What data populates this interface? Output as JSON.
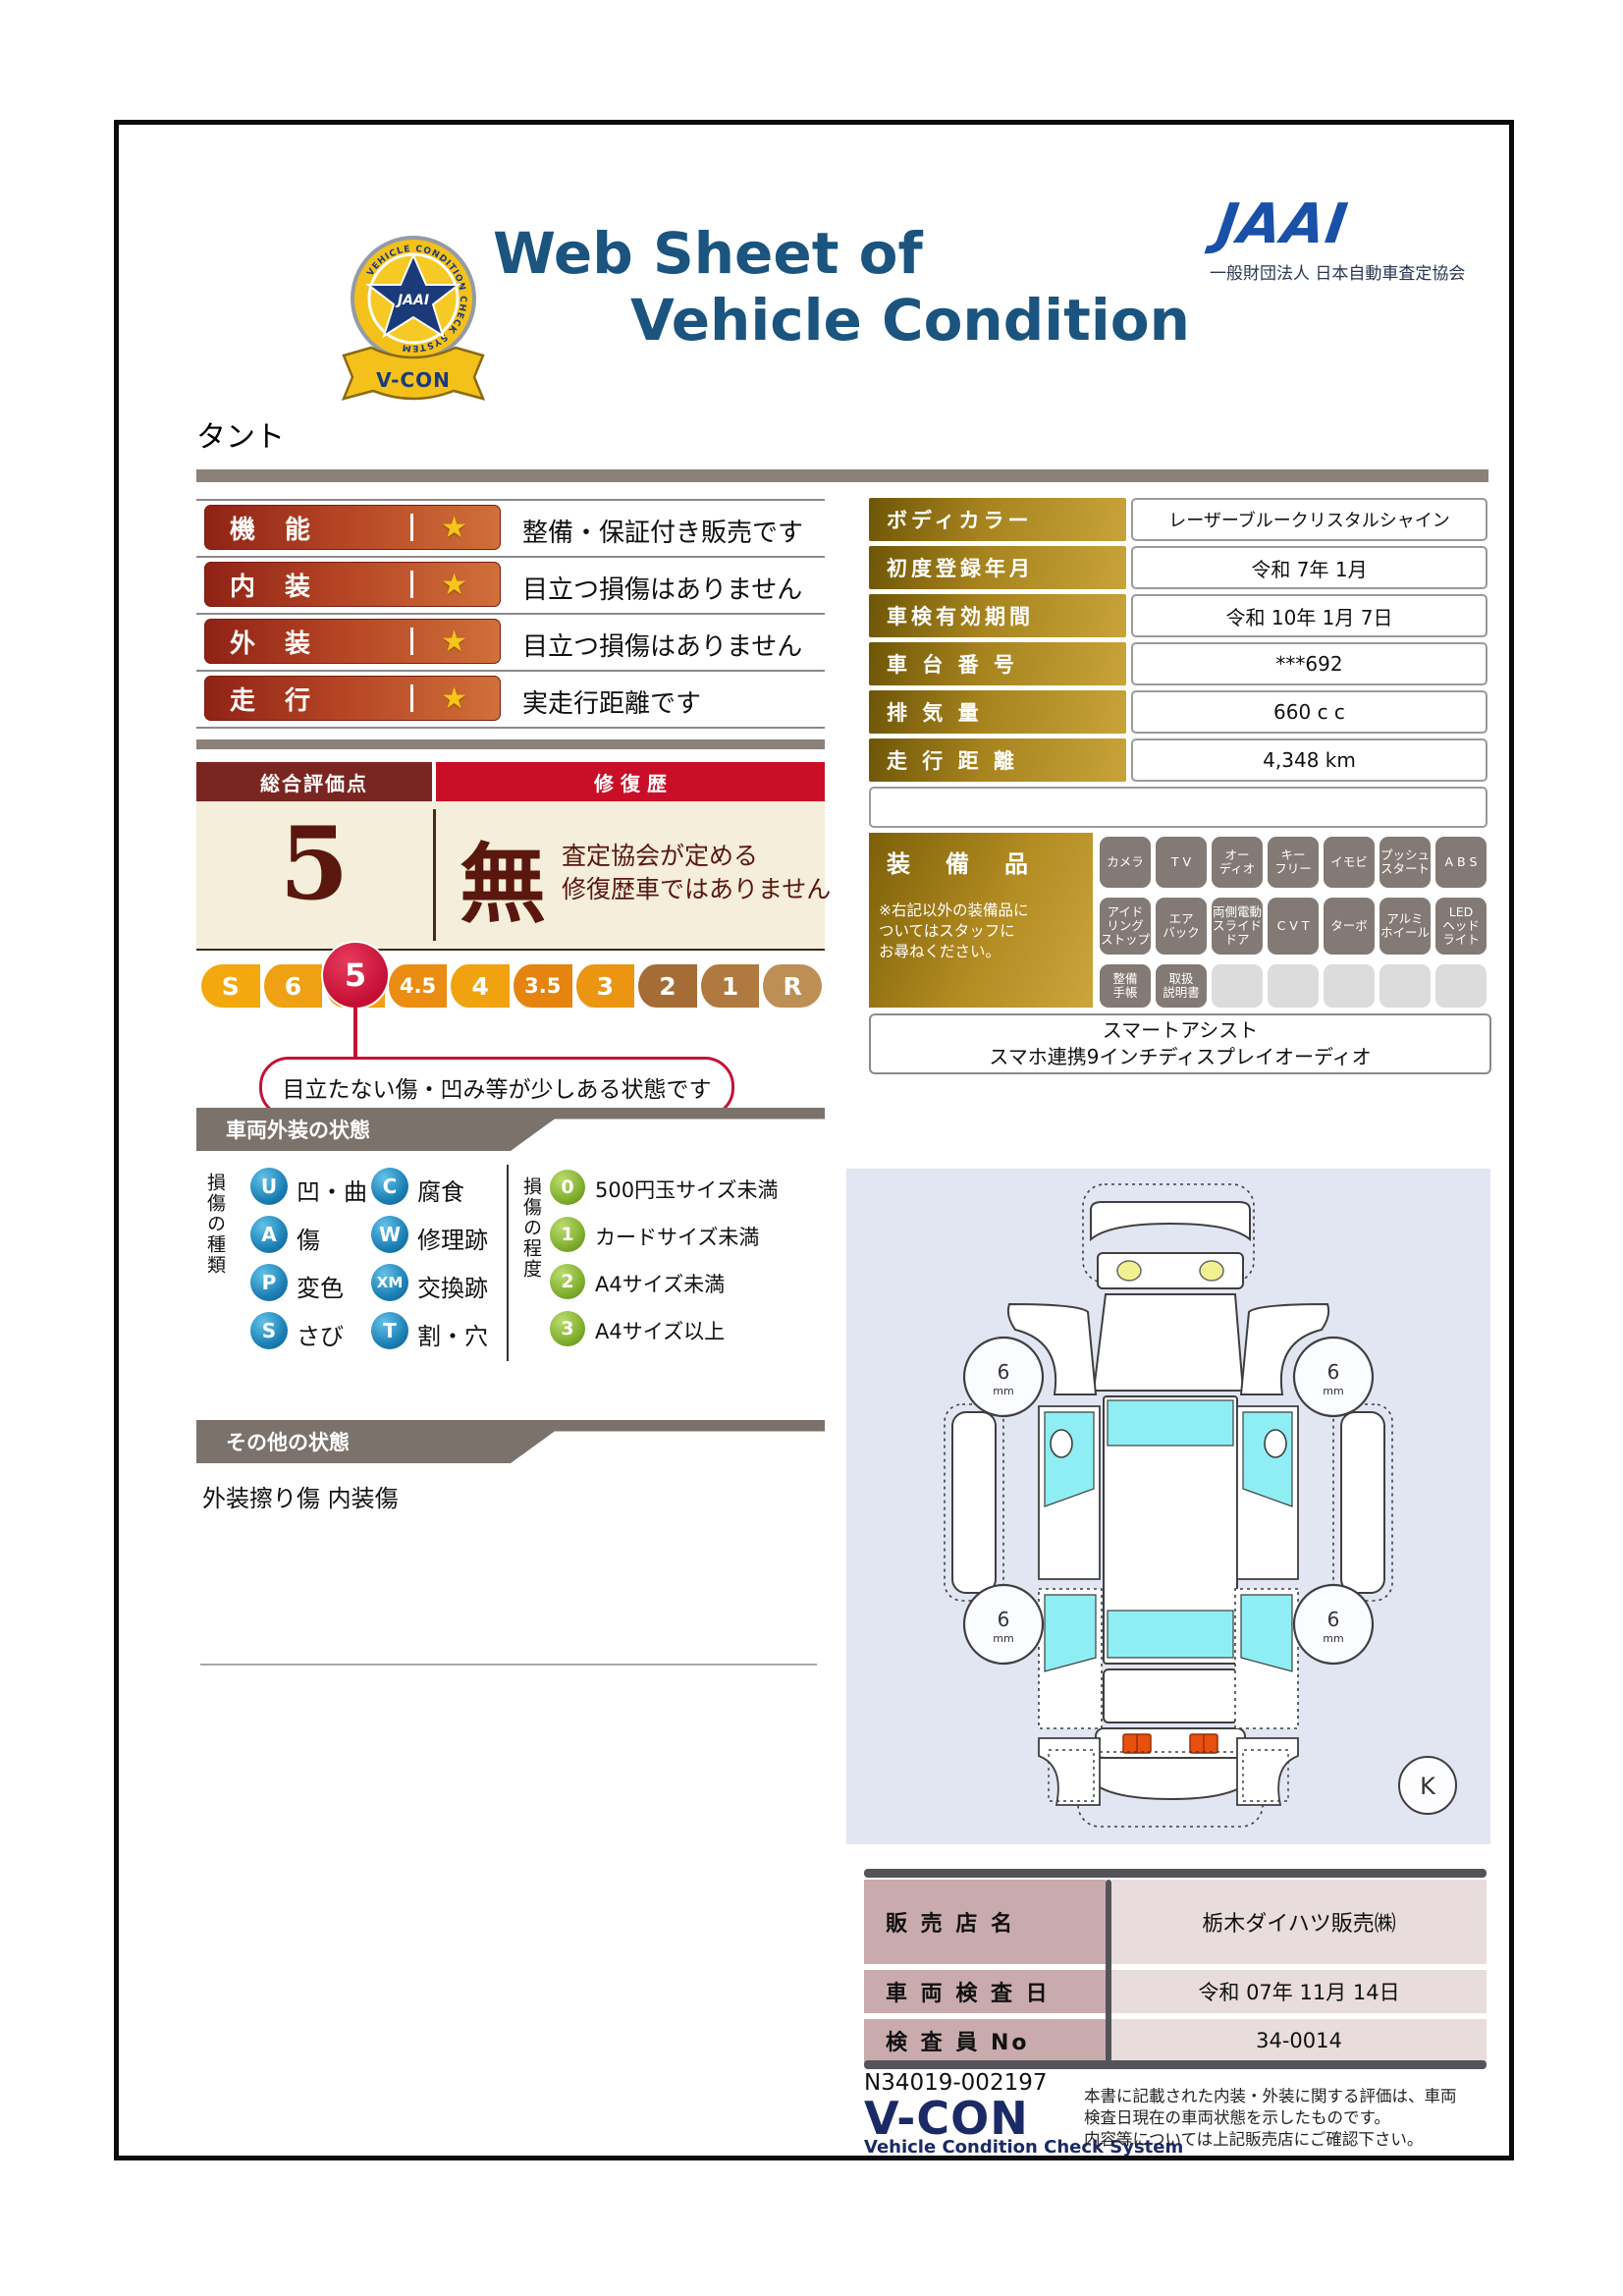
{
  "colors": {
    "title_navy": "#1a547f",
    "jaai_blue": "#1950a8",
    "badge_red": "#8f2216",
    "badge_orange": "#d0703a",
    "gold_dark": "#6e5607",
    "gold_light": "#c7a339",
    "summary_maroon": "#7b2521",
    "summary_red": "#c90f28",
    "summary_cream": "#f4eeda",
    "scale_crimson": "#c51236",
    "section_gray": "#7b726c",
    "type_blue": "#1b7fb4",
    "degree_green": "#7fae2e",
    "diagram_bg": "#e2e5f2",
    "window_cyan": "#8feef3",
    "dealer_pink": "#c9abae",
    "dealer_value_pink": "#e8dcdc",
    "vcon_navy": "#1b2a66"
  },
  "header": {
    "badge": {
      "ring_text": "VEHICLE CONDITION CHECK SYSTEM",
      "star_text": "JAAI",
      "ribbon_text": "V-CON"
    },
    "title_line1": "Web Sheet of",
    "title_line2": "Vehicle Condition",
    "jaai_wordmark": "JAAI",
    "jaai_subtitle": "一般財団法人 日本自動車査定協会"
  },
  "vehicle_name": "タント",
  "ratings": [
    {
      "label": "機　能",
      "star": "★",
      "desc": "整備・保証付き販売です"
    },
    {
      "label": "内　装",
      "star": "★",
      "desc": "目立つ損傷はありません"
    },
    {
      "label": "外　装",
      "star": "★",
      "desc": "目立つ損傷はありません"
    },
    {
      "label": "走　行",
      "star": "★",
      "desc": "実走行距離です"
    }
  ],
  "info_table": {
    "rows": [
      {
        "label": "ボディカラー",
        "value": "レーザーブルークリスタルシャイン"
      },
      {
        "label": "初度登録年月",
        "value": "令和 7年 1月"
      },
      {
        "label": "車検有効期間",
        "value": "令和 10年 1月 7日"
      },
      {
        "label": "車 台 番 号",
        "value": "***692"
      },
      {
        "label": "排 気 量",
        "value": "660 c c"
      },
      {
        "label": "走 行 距 離",
        "value": "4,348 km"
      }
    ]
  },
  "summary": {
    "header_left": "総合評価点",
    "header_right": "修 復 歴",
    "score": "5",
    "repair_flag": "無",
    "repair_note_line1": "査定協会が定める",
    "repair_note_line2": "修復歴車ではありません"
  },
  "scale": {
    "items": [
      "S",
      "6",
      "5",
      "4.5",
      "4",
      "3.5",
      "3",
      "2",
      "1",
      "R"
    ],
    "selected": "5",
    "callout": "目立たない傷・凹み等が少しある状態です"
  },
  "exterior": {
    "section_title": "車両外装の状態",
    "type_title": "損傷の種類",
    "types": [
      {
        "code": "U",
        "label": "凹・曲"
      },
      {
        "code": "C",
        "label": "腐食"
      },
      {
        "code": "A",
        "label": "傷"
      },
      {
        "code": "W",
        "label": "修理跡"
      },
      {
        "code": "P",
        "label": "変色"
      },
      {
        "code": "XM",
        "label": "交換跡"
      },
      {
        "code": "S",
        "label": "さび"
      },
      {
        "code": "T",
        "label": "割・穴"
      }
    ],
    "degree_title": "損傷の程度",
    "degrees": [
      {
        "code": "0",
        "label": "500円玉サイズ未満"
      },
      {
        "code": "1",
        "label": "カードサイズ未満"
      },
      {
        "code": "2",
        "label": "A4サイズ未満"
      },
      {
        "code": "3",
        "label": "A4サイズ以上"
      }
    ]
  },
  "other_condition": {
    "section_title": "その他の状態",
    "text": "外装擦り傷 内装傷"
  },
  "equipment": {
    "title": "装　備　品",
    "note": "※右記以外の装備品に\nついてはスタッフに\nお尋ねください。",
    "badges": [
      "カメラ",
      "T V",
      "オー\nディオ",
      "キー\nフリー",
      "イモビ",
      "プッシュ\nスタート",
      "A B S",
      "アイド\nリング\nストップ",
      "エア\nバック",
      "両側電動\nスライド\nドア",
      "C V T",
      "ターボ",
      "アルミ\nホイール",
      "LED\nヘッド\nライト",
      "整備\n手帳",
      "取扱\n説明書"
    ],
    "extra_line1": "スマートアシスト",
    "extra_line2": "スマホ連携9インチディスプレイオーディオ"
  },
  "diagram": {
    "tread_label": "6",
    "tread_unit": "mm",
    "corner_mark": "K"
  },
  "dealer_table": {
    "rows": [
      {
        "label": "販 売 店 名",
        "value": "栃木ダイハツ販売㈱"
      },
      {
        "label": "車 両 検 査 日",
        "value": "令和 07年 11月 14日"
      },
      {
        "label": "検 査 員 No",
        "value": "34-0014"
      }
    ]
  },
  "footer": {
    "serial": "N34019-002197",
    "vcon": "V-CON",
    "vcon_sub": "Vehicle Condition Check System",
    "note": "本書に記載された内装・外装に関する評価は、車両\n検査日現在の車両状態を示したものです。\n内容等については上記販売店にご確認下さい。"
  }
}
